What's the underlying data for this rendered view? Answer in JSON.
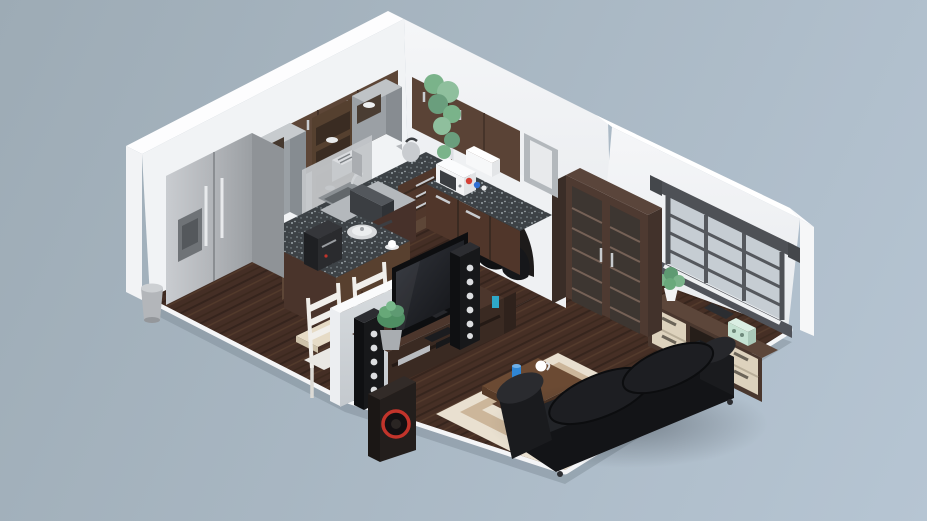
{
  "scene": {
    "type": "isometric-3d-cutaway-floor-plan-render",
    "description": "3D isometric cutaway floor plan render of an apartment with an open kitchen, dining nook, hallway with arched doorway and a living room, on a blue-gray background. No visible text.",
    "rooms": [
      {
        "name": "kitchen",
        "items": [
          "stainless side-by-side refrigerator with water dispenser",
          "steel trash can",
          "dark wood upper cabinets",
          "gray open shelving towers with white dishes and blue bowls",
          "hanging green plant on cabinet top",
          "granite L-shaped countertop",
          "stainless backsplash",
          "sink with faucet",
          "cooktop with gray vent hood block",
          "stainless toaster",
          "stainless kettle",
          "white microwave",
          "white paper-towel holder",
          "condiment bottles",
          "kitchen island with granite top",
          "black coffee machine",
          "stainless saucepan with lid",
          "cup and saucer",
          "base cabinets with drawers and steel handles"
        ]
      },
      {
        "name": "dining-nook",
        "items": [
          "light wood dining table",
          "two white ladder-back chairs"
        ]
      },
      {
        "name": "hallway",
        "items": [
          "arched doorway opening",
          "two black bean-bag chairs"
        ]
      },
      {
        "name": "living-room",
        "items": [
          "gray half-wall divider",
          "flat-screen TV",
          "dark wood TV stand with media components",
          "two black tower speakers with white cones",
          "subwoofer with red ring",
          "succulent in gray pot",
          "blue tumbler",
          "tall dark display cabinet with glass doors",
          "window with dark gray frame and mullions",
          "sideboard with cream drawers",
          "small potted plant",
          "dark tablet",
          "mint retro radio box",
          "red book",
          "beige striped area rug with concentric bands",
          "wooden two-tier coffee table",
          "blue cup",
          "white mug",
          "black leather sofa with two cushions"
        ]
      }
    ]
  },
  "palette": {
    "bg1": "#9dabb5",
    "bg2": "#b6c5d3",
    "wall": "#f1f3f5",
    "floor": "#4b3329",
    "granite": "#3d4246",
    "wood": "#5d4637",
    "cream": "#ddd2bd",
    "sofa": "#131417",
    "rug_light": "#e9e0d0",
    "rug_dark": "#ccb69a",
    "accent_blue": "#2f8fc9",
    "accent_red": "#c2342b",
    "plant": "#7ab38a",
    "mint": "#c5e2d2",
    "metal": "#b9bcc0"
  }
}
